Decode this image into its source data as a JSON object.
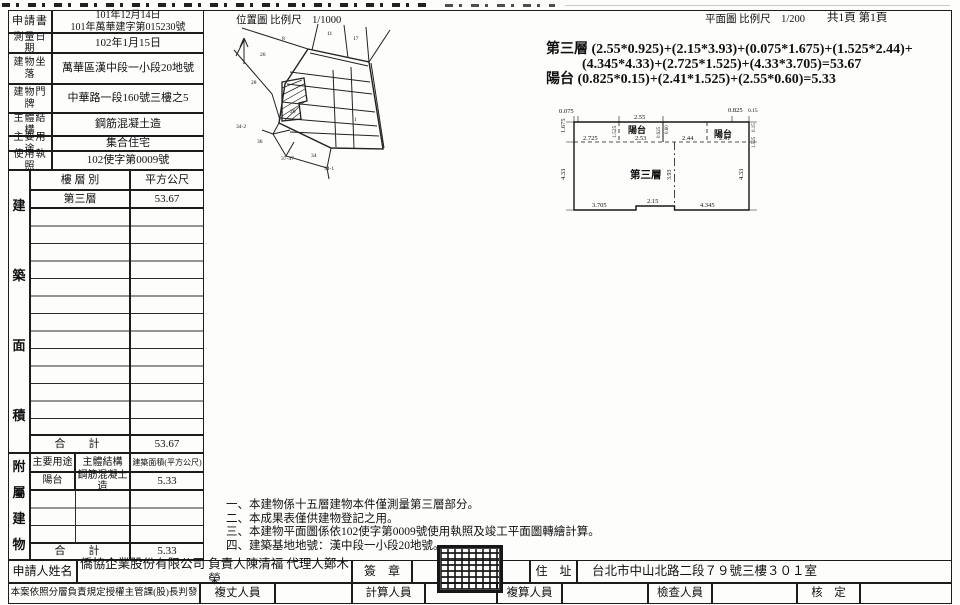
{
  "header": {
    "location_map_label": "位置圖 比例尺　1/1000",
    "floor_plan_label": "平面圖 比例尺　1/200",
    "page_count": "共1頁 第1頁"
  },
  "info_table": {
    "rows": [
      {
        "label": "申請書",
        "value": "101年12月14日\n101年萬華建字第015230號"
      },
      {
        "label": "測量日期",
        "value": "102年1月15日"
      },
      {
        "label": "建物坐落",
        "value": "萬華區漢中段一小段20地號"
      },
      {
        "label": "建物門牌",
        "value": "中華路一段160號三樓之5"
      },
      {
        "label": "主體結構",
        "value": "鋼筋混凝土造"
      },
      {
        "label": "主要用途",
        "value": "集合住宅"
      },
      {
        "label": "使用執照",
        "value": "102使字第0009號"
      }
    ]
  },
  "area_table": {
    "side_chars": [
      "建",
      "築",
      "面",
      "積"
    ],
    "col_floor": "樓 層 別",
    "col_sqm": "平方公尺",
    "row_floor": "第三層",
    "row_sqm": "53.67",
    "total_label": "合　計",
    "total_value": "53.67"
  },
  "annex_table": {
    "side_chars": [
      "附",
      "屬",
      "建",
      "物"
    ],
    "col_use": "主要用途",
    "col_structure": "主體結構",
    "col_area": "建築面積(平方公尺)",
    "row_use": "陽台",
    "row_structure": "鋼筋混凝土造",
    "row_area": "5.33",
    "total_label": "合　計",
    "total_value": "5.33"
  },
  "calc": {
    "line1": "第三層 (2.55*0.925)+(2.15*3.93)+(0.075*1.675)+(1.525*2.44)+",
    "line2": "(4.345*4.33)+(2.725*1.525)+(4.33*3.705)=53.67",
    "line3": "陽台 (0.825*0.15)+(2.41*1.525)+(2.55*0.60)=5.33"
  },
  "notes": {
    "items": [
      "一、本建物係十五層建物本件僅測量第三層部分。",
      "二、本成果表僅供建物登記之用。",
      "三、本建物平面圖係依102使字第0009號使用執照及竣工平面圖轉繪計算。",
      "四、建築基地地號：漢中段一小段20地號。"
    ]
  },
  "footer": {
    "applicant_label": "申請人姓名",
    "applicant_value": "僑協企業股份有限公司 負責人陳清福 代理人鄭木榮",
    "seal_label": "簽　章",
    "address_label": "住　址",
    "address_value": "台北市中山北路二段７９號三樓３０１室",
    "authorization_text": "本案依照分層負責規定授權主管課(股)長判發",
    "staff_labels": [
      "複丈人員",
      "計算人員",
      "複算人員",
      "檢查人員",
      "核　定"
    ]
  },
  "floor_plan": {
    "labels": [
      "0.075",
      "2.55",
      "0.825",
      "0.15",
      "1.675",
      "4.33",
      "1.525",
      "0.925",
      "0.60",
      "2.725",
      "2.53",
      "2.44",
      "2.41",
      "陽台",
      "陽台",
      "0.15",
      "1.525",
      "4.33",
      "3.93",
      "第三層",
      "3.705",
      "2.15",
      "4.345"
    ]
  },
  "location_map": {
    "parcels": [
      "8",
      "11",
      "17",
      "26",
      "28",
      "1",
      "20",
      "34-2",
      "36",
      "37-47",
      "34",
      "34-1"
    ]
  }
}
